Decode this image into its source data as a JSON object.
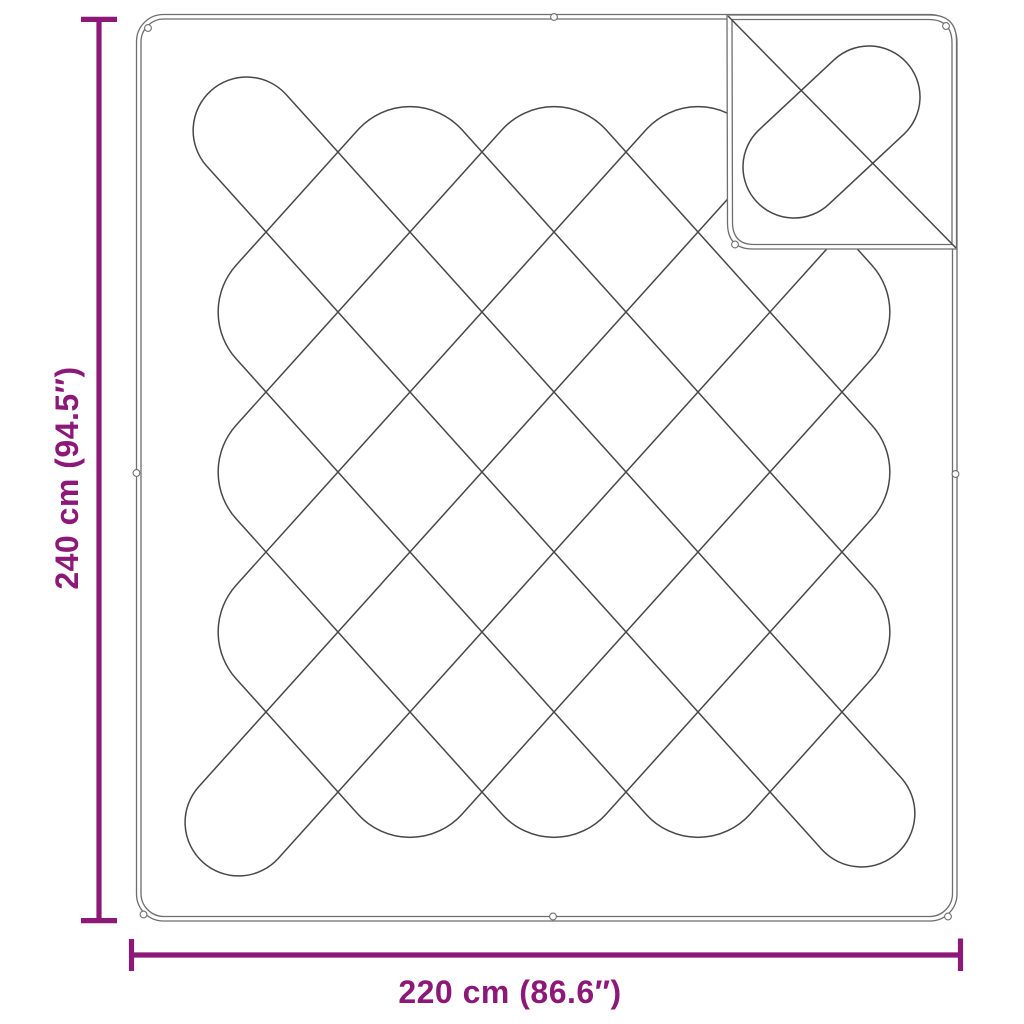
{
  "colors": {
    "dimension": "#8C1978",
    "outline": "#6e6e6e",
    "stitch": "#474747",
    "background": "#ffffff"
  },
  "dimensions": {
    "height": {
      "label": "240 cm (94.5″)"
    },
    "width": {
      "label": "220 cm (86.6″)"
    }
  }
}
